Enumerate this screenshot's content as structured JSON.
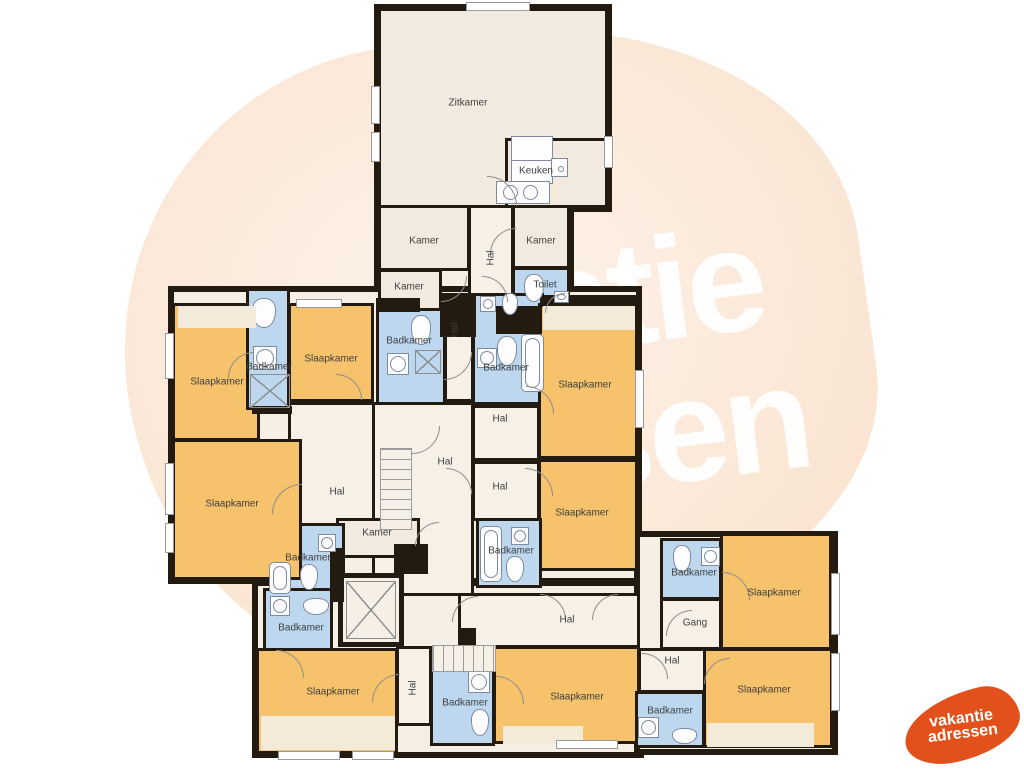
{
  "watermark": {
    "line1": "vakantie",
    "line2": "adressen"
  },
  "logo": {
    "line1": "vakantie",
    "line2": "adressen",
    "color": "#e2511c"
  },
  "colors": {
    "wall": "#241b10",
    "bedroom_orange": "#f6c26b",
    "bathroom_blue": "#bdd7ef",
    "room_cream": "#f2e9df",
    "hall_cream": "#f7f0e6",
    "shaft_cream": "#f6efe5",
    "watermark_blob": "#fbeadb",
    "logo_orange": "#e2511c"
  },
  "backdrops": [
    {
      "x": 374,
      "y": 4,
      "w": 238,
      "h": 208
    },
    {
      "x": 374,
      "y": 203,
      "w": 200,
      "h": 112
    },
    {
      "x": 168,
      "y": 286,
      "w": 474,
      "h": 298
    },
    {
      "x": 252,
      "y": 580,
      "w": 392,
      "h": 178
    },
    {
      "x": 634,
      "y": 531,
      "w": 204,
      "h": 224
    }
  ],
  "rooms": [
    {
      "id": "zitkamer",
      "x": 378,
      "y": 8,
      "w": 230,
      "h": 200,
      "k": "cream"
    },
    {
      "id": "keuken",
      "x": 505,
      "y": 138,
      "w": 103,
      "h": 70,
      "k": "cream"
    },
    {
      "id": "kamer-nw",
      "x": 378,
      "y": 205,
      "w": 92,
      "h": 66,
      "k": "cream"
    },
    {
      "id": "hal-top",
      "x": 468,
      "y": 205,
      "w": 46,
      "h": 106,
      "k": "hall"
    },
    {
      "id": "kamer-ne",
      "x": 512,
      "y": 205,
      "w": 58,
      "h": 64,
      "k": "cream"
    },
    {
      "id": "kamer-w",
      "x": 378,
      "y": 269,
      "w": 64,
      "h": 42,
      "k": "cream"
    },
    {
      "id": "toilet",
      "x": 512,
      "y": 267,
      "w": 58,
      "h": 44,
      "k": "blue"
    },
    {
      "id": "slaapkamer-nw",
      "x": 172,
      "y": 303,
      "w": 88,
      "h": 138,
      "k": "orange"
    },
    {
      "id": "badkamer-strip",
      "x": 246,
      "y": 288,
      "w": 44,
      "h": 122,
      "k": "blue"
    },
    {
      "id": "slaapkamer-n",
      "x": 288,
      "y": 303,
      "w": 86,
      "h": 99,
      "k": "orange"
    },
    {
      "id": "badkamer-c1",
      "x": 376,
      "y": 308,
      "w": 70,
      "h": 102,
      "k": "blue"
    },
    {
      "id": "hal-corr1",
      "x": 444,
      "y": 303,
      "w": 30,
      "h": 99,
      "k": "hall"
    },
    {
      "id": "badkamer-c2",
      "x": 472,
      "y": 293,
      "w": 72,
      "h": 112,
      "k": "blue"
    },
    {
      "id": "slaapkamer-e1",
      "x": 538,
      "y": 303,
      "w": 100,
      "h": 156,
      "k": "orange"
    },
    {
      "id": "slaapkamer-e2",
      "x": 538,
      "y": 459,
      "w": 100,
      "h": 112,
      "k": "orange"
    },
    {
      "id": "hal-w",
      "x": 288,
      "y": 402,
      "w": 88,
      "h": 130,
      "k": "hall"
    },
    {
      "id": "hal-center",
      "x": 372,
      "y": 402,
      "w": 102,
      "h": 194,
      "k": "hall"
    },
    {
      "id": "hal-c1",
      "x": 472,
      "y": 405,
      "w": 68,
      "h": 56,
      "k": "hall"
    },
    {
      "id": "hal-c2",
      "x": 472,
      "y": 461,
      "w": 68,
      "h": 60,
      "k": "hall"
    },
    {
      "id": "kamer-s",
      "x": 336,
      "y": 518,
      "w": 84,
      "h": 40,
      "k": "cream"
    },
    {
      "id": "badkamer-w1",
      "x": 281,
      "y": 523,
      "w": 64,
      "h": 74,
      "k": "blue"
    },
    {
      "id": "badkamer-w2",
      "x": 263,
      "y": 588,
      "w": 70,
      "h": 64,
      "k": "blue"
    },
    {
      "id": "lift",
      "x": 338,
      "y": 573,
      "w": 66,
      "h": 74,
      "k": "shaft"
    },
    {
      "id": "badkamer-c3",
      "x": 476,
      "y": 518,
      "w": 66,
      "h": 70,
      "k": "blue"
    },
    {
      "id": "slaapkamer-w",
      "x": 172,
      "y": 439,
      "w": 130,
      "h": 141,
      "k": "orange"
    },
    {
      "id": "hal-s",
      "x": 458,
      "y": 593,
      "w": 182,
      "h": 55,
      "k": "hall"
    },
    {
      "id": "slaapkamer-s1",
      "x": 493,
      "y": 646,
      "w": 147,
      "h": 98,
      "k": "orange"
    },
    {
      "id": "badkamer-s",
      "x": 430,
      "y": 666,
      "w": 65,
      "h": 80,
      "k": "blue"
    },
    {
      "id": "hal-sv",
      "x": 396,
      "y": 646,
      "w": 36,
      "h": 80,
      "k": "hall"
    },
    {
      "id": "slaapkamer-sw",
      "x": 256,
      "y": 648,
      "w": 142,
      "h": 106,
      "k": "orange"
    },
    {
      "id": "badkamer-e1",
      "x": 660,
      "y": 538,
      "w": 62,
      "h": 62,
      "k": "blue"
    },
    {
      "id": "gang",
      "x": 660,
      "y": 598,
      "w": 62,
      "h": 52,
      "k": "hall"
    },
    {
      "id": "slaapkamer-e3",
      "x": 720,
      "y": 533,
      "w": 112,
      "h": 117,
      "k": "orange"
    },
    {
      "id": "hal-e",
      "x": 638,
      "y": 648,
      "w": 68,
      "h": 45,
      "k": "hall"
    },
    {
      "id": "badkamer-e2",
      "x": 635,
      "y": 691,
      "w": 70,
      "h": 57,
      "k": "blue"
    },
    {
      "id": "slaapkamer-se",
      "x": 703,
      "y": 648,
      "w": 130,
      "h": 100,
      "k": "orange"
    }
  ],
  "labels": [
    {
      "t": "Zitkamer",
      "x": 468,
      "y": 103
    },
    {
      "t": "Keuken",
      "x": 536,
      "y": 171
    },
    {
      "t": "Kamer",
      "x": 424,
      "y": 241
    },
    {
      "t": "Kamer",
      "x": 541,
      "y": 241
    },
    {
      "t": "Hal",
      "x": 491,
      "y": 258,
      "r": 1
    },
    {
      "t": "Kamer",
      "x": 409,
      "y": 287
    },
    {
      "t": "Toilet",
      "x": 545,
      "y": 285
    },
    {
      "t": "Slaapkamer",
      "x": 217,
      "y": 382
    },
    {
      "t": "Badkamer",
      "x": 269,
      "y": 367
    },
    {
      "t": "Slaapkamer",
      "x": 331,
      "y": 359
    },
    {
      "t": "Badkamer",
      "x": 409,
      "y": 341
    },
    {
      "t": "Hal",
      "x": 455,
      "y": 330,
      "r": 1
    },
    {
      "t": "Badkamer",
      "x": 506,
      "y": 368
    },
    {
      "t": "Slaapkamer",
      "x": 585,
      "y": 385
    },
    {
      "t": "Hal",
      "x": 500,
      "y": 419
    },
    {
      "t": "Hal",
      "x": 445,
      "y": 462
    },
    {
      "t": "Hal",
      "x": 337,
      "y": 492
    },
    {
      "t": "Hal",
      "x": 500,
      "y": 487
    },
    {
      "t": "Slaapkamer",
      "x": 232,
      "y": 504
    },
    {
      "t": "Slaapkamer",
      "x": 582,
      "y": 513
    },
    {
      "t": "Kamer",
      "x": 377,
      "y": 533
    },
    {
      "t": "Badkamer",
      "x": 511,
      "y": 551
    },
    {
      "t": "Badkamer",
      "x": 308,
      "y": 558
    },
    {
      "t": "Badkamer",
      "x": 301,
      "y": 628
    },
    {
      "t": "Badkamer",
      "x": 694,
      "y": 573
    },
    {
      "t": "Gang",
      "x": 695,
      "y": 623
    },
    {
      "t": "Slaapkamer",
      "x": 774,
      "y": 593
    },
    {
      "t": "Hal",
      "x": 567,
      "y": 620
    },
    {
      "t": "Hal",
      "x": 672,
      "y": 661
    },
    {
      "t": "Slaapkamer",
      "x": 333,
      "y": 692
    },
    {
      "t": "Hal",
      "x": 413,
      "y": 688,
      "r": 1
    },
    {
      "t": "Slaapkamer",
      "x": 577,
      "y": 697
    },
    {
      "t": "Badkamer",
      "x": 465,
      "y": 703
    },
    {
      "t": "Slaapkamer",
      "x": 764,
      "y": 690
    },
    {
      "t": "Badkamer",
      "x": 670,
      "y": 711
    }
  ],
  "walls": [
    {
      "x": 376,
      "y": 298,
      "w": 44,
      "h": 14
    },
    {
      "x": 440,
      "y": 293,
      "w": 36,
      "h": 44
    },
    {
      "x": 496,
      "y": 306,
      "w": 46,
      "h": 28
    },
    {
      "x": 540,
      "y": 295,
      "w": 98,
      "h": 12
    },
    {
      "x": 394,
      "y": 544,
      "w": 34,
      "h": 30
    },
    {
      "x": 330,
      "y": 548,
      "w": 14,
      "h": 54
    },
    {
      "x": 252,
      "y": 406,
      "w": 40,
      "h": 8
    },
    {
      "x": 458,
      "y": 628,
      "w": 18,
      "h": 20
    }
  ],
  "windows": [
    {
      "x": 466,
      "y": 2,
      "w": 64,
      "h": 9
    },
    {
      "x": 371,
      "y": 86,
      "w": 9,
      "h": 38
    },
    {
      "x": 371,
      "y": 132,
      "w": 9,
      "h": 30
    },
    {
      "x": 604,
      "y": 136,
      "w": 9,
      "h": 32
    },
    {
      "x": 296,
      "y": 299,
      "w": 46,
      "h": 9
    },
    {
      "x": 165,
      "y": 333,
      "w": 9,
      "h": 46
    },
    {
      "x": 165,
      "y": 463,
      "w": 9,
      "h": 52
    },
    {
      "x": 165,
      "y": 523,
      "w": 9,
      "h": 30
    },
    {
      "x": 635,
      "y": 370,
      "w": 9,
      "h": 58
    },
    {
      "x": 831,
      "y": 573,
      "w": 9,
      "h": 62
    },
    {
      "x": 831,
      "y": 653,
      "w": 9,
      "h": 58
    },
    {
      "x": 278,
      "y": 751,
      "w": 62,
      "h": 9
    },
    {
      "x": 352,
      "y": 751,
      "w": 42,
      "h": 9
    },
    {
      "x": 556,
      "y": 740,
      "w": 62,
      "h": 9
    }
  ],
  "doors": [
    {
      "x": 487,
      "y": 176,
      "s": 30,
      "r": 90
    },
    {
      "x": 490,
      "y": 228,
      "s": 26,
      "r": 0
    },
    {
      "x": 441,
      "y": 276,
      "s": 26,
      "r": 180
    },
    {
      "x": 545,
      "y": 293,
      "s": 20,
      "r": 0
    },
    {
      "x": 482,
      "y": 276,
      "s": 26,
      "r": 90
    },
    {
      "x": 228,
      "y": 352,
      "s": 26,
      "r": 0
    },
    {
      "x": 336,
      "y": 374,
      "s": 26,
      "r": 90
    },
    {
      "x": 444,
      "y": 352,
      "s": 28,
      "r": 180
    },
    {
      "x": 526,
      "y": 386,
      "s": 28,
      "r": 90
    },
    {
      "x": 412,
      "y": 426,
      "s": 28,
      "r": 180
    },
    {
      "x": 446,
      "y": 468,
      "s": 26,
      "r": 90
    },
    {
      "x": 525,
      "y": 468,
      "s": 28,
      "r": 90
    },
    {
      "x": 272,
      "y": 484,
      "s": 30,
      "r": 0
    },
    {
      "x": 415,
      "y": 522,
      "s": 24,
      "r": 0
    },
    {
      "x": 452,
      "y": 596,
      "s": 26,
      "r": 0
    },
    {
      "x": 540,
      "y": 594,
      "s": 26,
      "r": 90
    },
    {
      "x": 592,
      "y": 594,
      "s": 26,
      "r": 0
    },
    {
      "x": 276,
      "y": 650,
      "s": 28,
      "r": 90
    },
    {
      "x": 372,
      "y": 674,
      "s": 28,
      "r": 0
    },
    {
      "x": 496,
      "y": 676,
      "s": 28,
      "r": 90
    },
    {
      "x": 722,
      "y": 572,
      "s": 28,
      "r": 90
    },
    {
      "x": 666,
      "y": 610,
      "s": 26,
      "r": 0
    },
    {
      "x": 642,
      "y": 653,
      "s": 26,
      "r": 90
    },
    {
      "x": 704,
      "y": 658,
      "s": 26,
      "r": 0
    }
  ],
  "fixtures": [
    {
      "t": "toilet",
      "x": 252,
      "y": 298,
      "w": 24,
      "h": 30
    },
    {
      "t": "sink",
      "x": 253,
      "y": 346,
      "w": 24,
      "h": 24
    },
    {
      "t": "cross",
      "x": 250,
      "y": 374,
      "w": 40,
      "h": 34
    },
    {
      "t": "toilet",
      "x": 411,
      "y": 315,
      "w": 20,
      "h": 30
    },
    {
      "t": "sink",
      "x": 387,
      "y": 353,
      "w": 22,
      "h": 22
    },
    {
      "t": "cross",
      "x": 415,
      "y": 350,
      "w": 26,
      "h": 24
    },
    {
      "t": "toilet",
      "x": 497,
      "y": 336,
      "w": 20,
      "h": 30
    },
    {
      "t": "sink",
      "x": 477,
      "y": 348,
      "w": 20,
      "h": 20
    },
    {
      "t": "tub",
      "x": 521,
      "y": 334,
      "w": 23,
      "h": 58
    },
    {
      "t": "toilet",
      "x": 502,
      "y": 293,
      "w": 16,
      "h": 22
    },
    {
      "t": "sink",
      "x": 480,
      "y": 296,
      "w": 16,
      "h": 16
    },
    {
      "t": "toilet",
      "x": 524,
      "y": 274,
      "w": 20,
      "h": 28
    },
    {
      "t": "sink",
      "x": 554,
      "y": 291,
      "w": 15,
      "h": 12
    },
    {
      "t": "tub",
      "x": 480,
      "y": 526,
      "w": 22,
      "h": 56
    },
    {
      "t": "sink",
      "x": 511,
      "y": 527,
      "w": 18,
      "h": 18
    },
    {
      "t": "toilet",
      "x": 506,
      "y": 556,
      "w": 18,
      "h": 26
    },
    {
      "t": "sink",
      "x": 318,
      "y": 534,
      "w": 18,
      "h": 18
    },
    {
      "t": "toilet",
      "x": 300,
      "y": 564,
      "w": 18,
      "h": 26
    },
    {
      "t": "tub",
      "x": 269,
      "y": 562,
      "w": 22,
      "h": 32
    },
    {
      "t": "sink",
      "x": 270,
      "y": 596,
      "w": 20,
      "h": 20
    },
    {
      "t": "toilet",
      "x": 303,
      "y": 598,
      "w": 26,
      "h": 17
    },
    {
      "t": "cross",
      "x": 346,
      "y": 581,
      "w": 50,
      "h": 58
    },
    {
      "t": "toilet",
      "x": 673,
      "y": 545,
      "w": 18,
      "h": 27
    },
    {
      "t": "sink",
      "x": 701,
      "y": 547,
      "w": 19,
      "h": 19
    },
    {
      "t": "sink",
      "x": 638,
      "y": 717,
      "w": 21,
      "h": 21
    },
    {
      "t": "toilet",
      "x": 672,
      "y": 728,
      "w": 25,
      "h": 16
    },
    {
      "t": "sink",
      "x": 468,
      "y": 671,
      "w": 22,
      "h": 22
    },
    {
      "t": "toilet",
      "x": 471,
      "y": 709,
      "w": 18,
      "h": 27
    },
    {
      "t": "counter",
      "x": 511,
      "y": 136,
      "w": 42,
      "h": 48
    },
    {
      "t": "ksink",
      "x": 496,
      "y": 181,
      "w": 54,
      "h": 23
    },
    {
      "t": "appliance",
      "x": 551,
      "y": 158,
      "w": 17,
      "h": 19
    },
    {
      "t": "inset",
      "x": 178,
      "y": 306,
      "w": 78,
      "h": 22
    },
    {
      "t": "inset",
      "x": 543,
      "y": 306,
      "w": 92,
      "h": 24
    },
    {
      "t": "inset",
      "x": 261,
      "y": 716,
      "w": 134,
      "h": 34
    },
    {
      "t": "inset",
      "x": 503,
      "y": 726,
      "w": 80,
      "h": 18
    },
    {
      "t": "inset",
      "x": 707,
      "y": 723,
      "w": 107,
      "h": 24
    },
    {
      "t": "stairs-h",
      "x": 380,
      "y": 448,
      "w": 32,
      "h": 82
    },
    {
      "t": "stairs-v",
      "x": 432,
      "y": 645,
      "w": 64,
      "h": 27
    }
  ]
}
